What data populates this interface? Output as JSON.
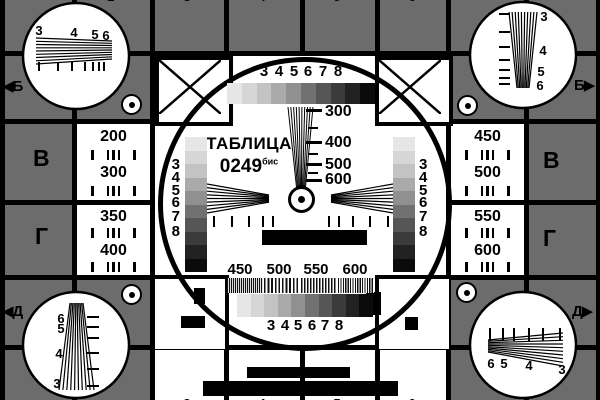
{
  "colors": {
    "background": "#6c6c6c",
    "ink": "#000000",
    "paper": "#ffffff",
    "grayscale_steps": [
      "#e6e6e6",
      "#d6d6d6",
      "#c3c3c3",
      "#aaaaaa",
      "#909090",
      "#717171",
      "#565656",
      "#3b3b3b",
      "#222222",
      "#0b0b0b"
    ]
  },
  "title": {
    "name": "ТАБЛИЦА",
    "number": "0249",
    "suffix": "бис"
  },
  "edges": {
    "top_digits": [
      "2",
      "3",
      "4",
      "5",
      "6"
    ],
    "bottom_digits": [
      "3",
      "4",
      "5",
      "6"
    ],
    "row_b_left": "◀Б",
    "row_b_right": "Б▶",
    "row_v_left": "В",
    "row_v_right": "В",
    "row_g_left": "Г",
    "row_g_right": "Г",
    "row_d_left": "◀Д",
    "row_d_right": "Д▶"
  },
  "left_panel": {
    "values": [
      "200",
      "300",
      "350",
      "400"
    ]
  },
  "right_panel": {
    "values": [
      "450",
      "500",
      "550",
      "600"
    ]
  },
  "circle": {
    "top_scale": [
      "3",
      "4",
      "5",
      "6",
      "7",
      "8"
    ],
    "bottom_scale": [
      "3",
      "4",
      "5",
      "6",
      "7",
      "8"
    ],
    "left_scale": [
      "3",
      "4",
      "5",
      "6",
      "7",
      "8"
    ],
    "right_scale": [
      "3",
      "4",
      "5",
      "6",
      "7",
      "8"
    ],
    "wedge_marks": [
      "300",
      "400",
      "500",
      "600"
    ],
    "burst_marks": [
      "450",
      "500",
      "550",
      "600"
    ]
  },
  "corners": {
    "top_left": [
      "3",
      "4",
      "5",
      "6"
    ],
    "top_right": [
      "3",
      "4",
      "5",
      "6"
    ],
    "bottom_left": [
      "6",
      "5",
      "4",
      "3"
    ],
    "bottom_right": [
      "6",
      "5",
      "4",
      "3"
    ]
  }
}
